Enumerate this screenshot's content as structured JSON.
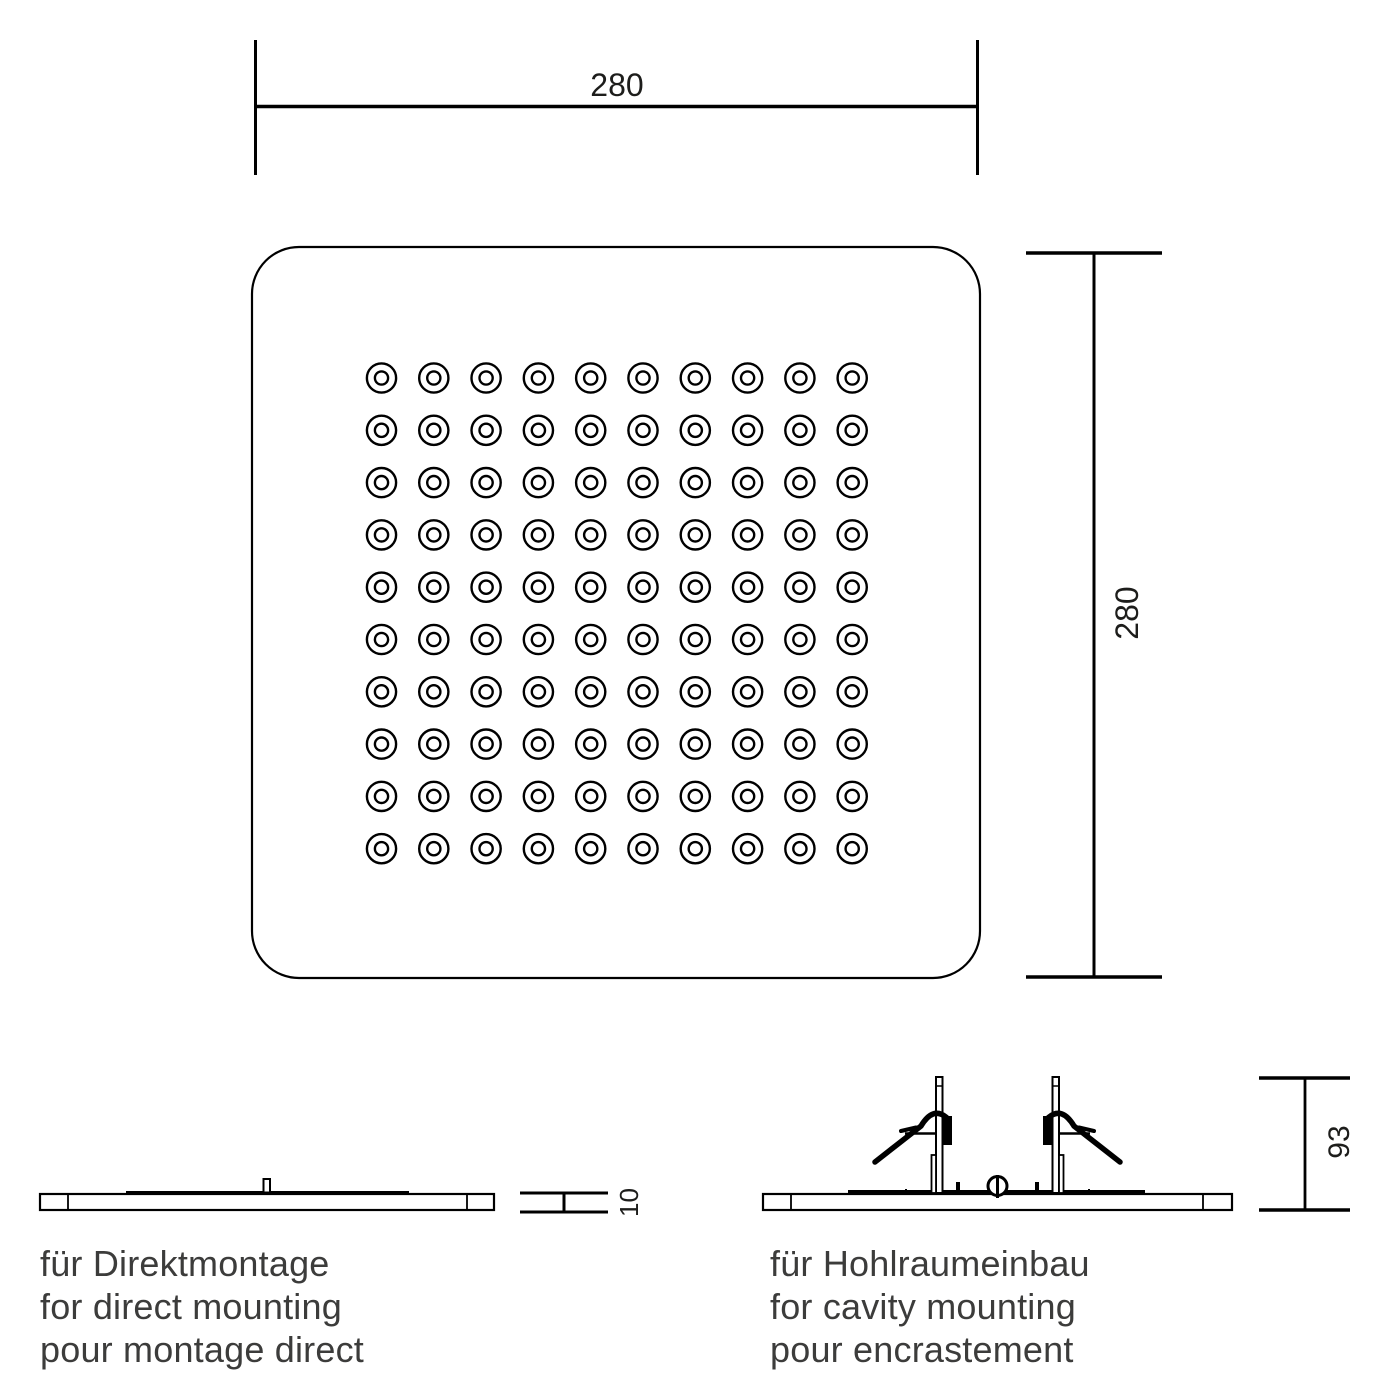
{
  "drawing": {
    "background": "#ffffff",
    "line_color": "#000000",
    "dim_text_color": "#1d1d1b",
    "caption_text_color": "#3c3c3b",
    "top_view": {
      "width_dimension": "280",
      "height_dimension": "280",
      "nozzle_grid": {
        "rows": 10,
        "cols": 10
      }
    },
    "profiles": {
      "direct_mount": {
        "thickness_dimension": "10",
        "caption_de": "für Direktmontage",
        "caption_en": "for direct mounting",
        "caption_fr": "pour montage direct"
      },
      "cavity_mount": {
        "height_dimension": "93",
        "caption_de": "für Hohlraumeinbau",
        "caption_en": "for cavity mounting",
        "caption_fr": "pour encrastement"
      }
    }
  }
}
